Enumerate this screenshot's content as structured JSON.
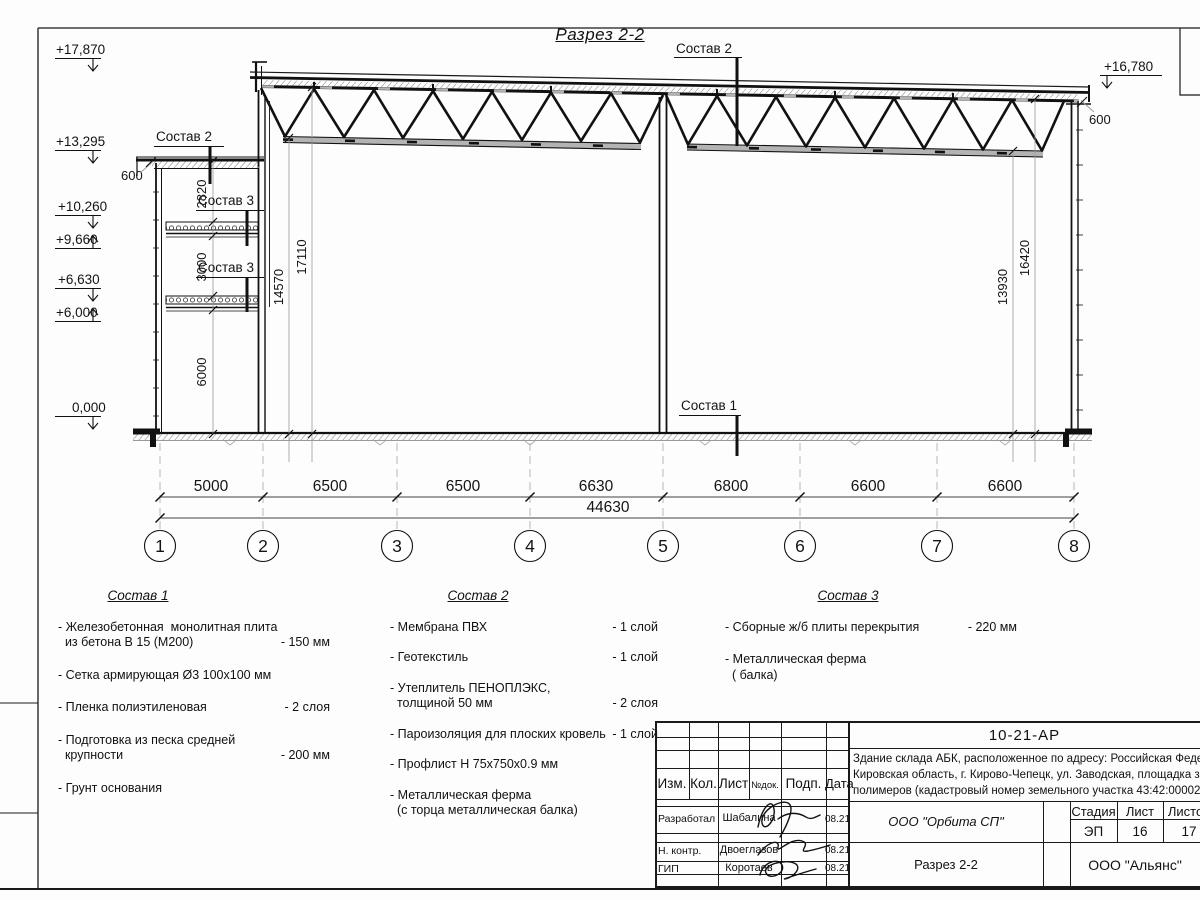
{
  "drawing": {
    "title": "Разрез 2-2",
    "elev_17870": "+17,870",
    "elev_13295": "+13,295",
    "elev_10260": "+10,260",
    "elev_9660": "+9,660",
    "elev_6630": "+6,630",
    "elev_6000": "+6,000",
    "elev_0": "0,000",
    "elev_16780": "+16,780",
    "overhang_left": "600",
    "overhang_right": "600",
    "dim_2820": "2820",
    "dim_3000": "3000",
    "dim_6000": "6000",
    "dim_14570": "14570",
    "dim_17110": "17110",
    "dim_13930": "13930",
    "dim_16420": "16420",
    "callout_sostav1": "Состав 1",
    "callout_sostav2": "Состав 2",
    "callout_sostav3": "Состав 3",
    "bottom_dims": [
      "5000",
      "6500",
      "6500",
      "6630",
      "6800",
      "6600",
      "6600"
    ],
    "total_dim": "44630",
    "bubbles": [
      "1",
      "2",
      "3",
      "4",
      "5",
      "6",
      "7",
      "8"
    ]
  },
  "legend": {
    "col1": {
      "title": "Состав 1",
      "items": [
        {
          "name": "- Железобетонная  монолитная плита\n  из бетона В 15 (М200)",
          "qty": "- 150 мм"
        },
        {
          "name": "- Сетка армирующая Ø3 100х100 мм",
          "qty": ""
        },
        {
          "name": "- Пленка полиэтиленовая",
          "qty": "-  2 слоя"
        },
        {
          "name": "- Подготовка из песка средней\n  крупности",
          "qty": "- 200 мм"
        },
        {
          "name": "- Грунт основания",
          "qty": ""
        }
      ]
    },
    "col2": {
      "title": "Состав 2",
      "items": [
        {
          "name": "- Мембрана ПВХ",
          "qty": "- 1 слой"
        },
        {
          "name": "- Геотекстиль",
          "qty": "- 1 слой"
        },
        {
          "name": "- Утеплитель ПЕНОПЛЭКС,\n  толщиной 50 мм",
          "qty": "- 2 слоя"
        },
        {
          "name": "- Пароизоляция для плоских кровель",
          "qty": "- 1 слой"
        },
        {
          "name": "- Профлист Н 75х750х0.9 мм",
          "qty": ""
        },
        {
          "name": "- Металлическая ферма\n  (с торца металлическая балка)",
          "qty": ""
        }
      ]
    },
    "col3": {
      "title": "Состав 3",
      "items": [
        {
          "name": "- Сборные ж/б плиты перекрытия",
          "qty": "- 220 мм"
        },
        {
          "name": "- Металлическая ферма\n  ( балка)",
          "qty": ""
        }
      ]
    }
  },
  "titleblock": {
    "doc_number": "10-21-АР",
    "description": "Здание склада АБК, расположенное по адресу: Российская Федерация,\nКировская область, г. Кирово-Чепецк, ул. Заводская, площадка завода\nполимеров (кадастровый номер земельного участка 43:42:000022:3",
    "col_izm": "Изм.",
    "col_kol": "Кол.",
    "col_list": "Лист",
    "col_ndok": "№док.",
    "col_podp": "Подп.",
    "col_data": "Дата",
    "row1_role": "Разработал",
    "row1_name": "Шабалина",
    "row1_date": "08.21",
    "row2_role": "Н. контр.",
    "row2_name": "Двоеглазов",
    "row2_date": "08.21",
    "row3_role": "ГИП",
    "row3_name": "Коротаев",
    "row3_date": "08.21",
    "org": "ООО \"Орбита СП\"",
    "stage_label": "Стадия",
    "sheet_label": "Лист",
    "sheets_label": "Листов",
    "stage": "ЭП",
    "sheet": "16",
    "sheets": "17",
    "drawing_name": "Разрез 2-2",
    "company": "ООО \"Альянс\""
  }
}
